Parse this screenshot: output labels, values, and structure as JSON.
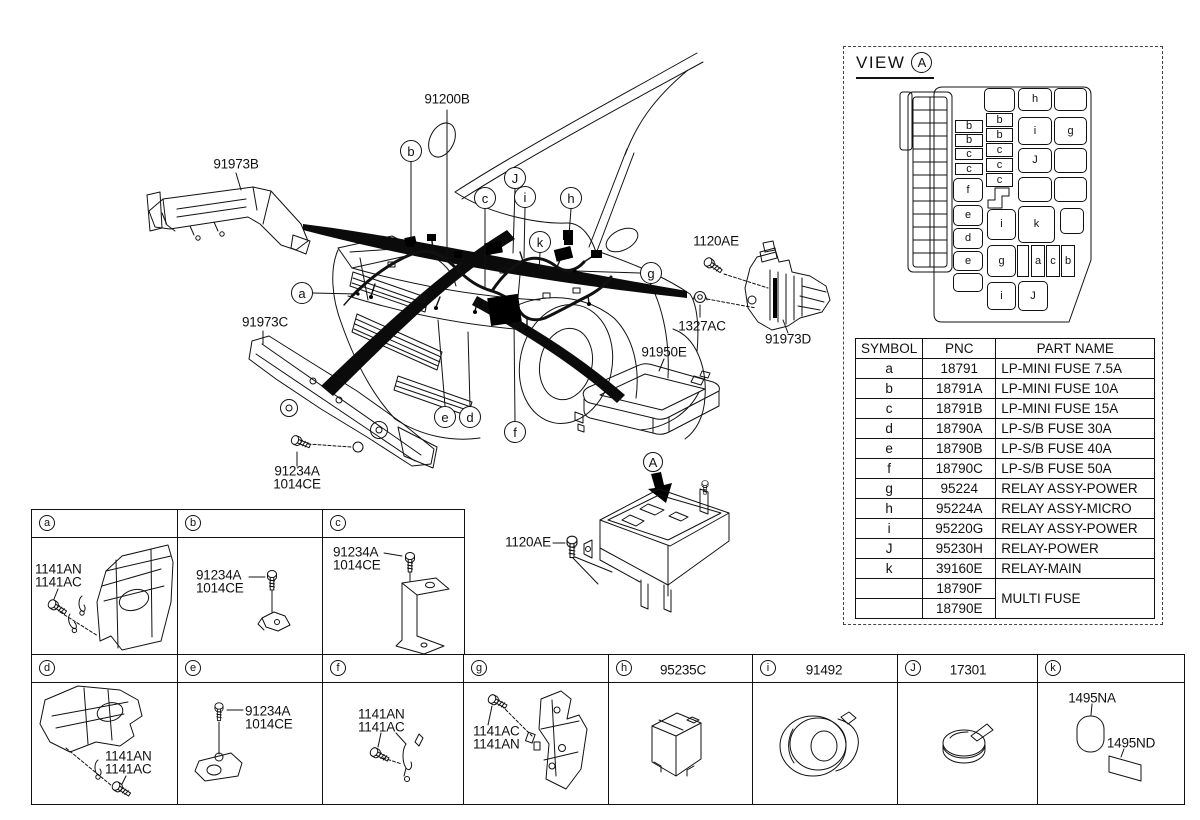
{
  "view_a": {
    "title": "VIEW",
    "balloon": "A",
    "table": {
      "headers": [
        "SYMBOL",
        "PNC",
        "PART NAME"
      ],
      "rows": [
        {
          "s": "a",
          "p": "18791",
          "n": "LP-MINI FUSE 7.5A"
        },
        {
          "s": "b",
          "p": "18791A",
          "n": "LP-MINI FUSE 10A"
        },
        {
          "s": "c",
          "p": "18791B",
          "n": "LP-MINI FUSE 15A"
        },
        {
          "s": "d",
          "p": "18790A",
          "n": "LP-S/B FUSE 30A"
        },
        {
          "s": "e",
          "p": "18790B",
          "n": "LP-S/B FUSE 40A"
        },
        {
          "s": "f",
          "p": "18790C",
          "n": "LP-S/B FUSE 50A"
        },
        {
          "s": "g",
          "p": "95224",
          "n": "RELAY ASSY-POWER"
        },
        {
          "s": "h",
          "p": "95224A",
          "n": "RELAY ASSY-MICRO"
        },
        {
          "s": "i",
          "p": "95220G",
          "n": "RELAY ASSY-POWER"
        },
        {
          "s": "J",
          "p": "95230H",
          "n": "RELAY-POWER"
        },
        {
          "s": "k",
          "p": "39160E",
          "n": "RELAY-MAIN"
        },
        {
          "s": "",
          "p": "18790F",
          "n": "MULTI FUSE",
          "span": 2
        },
        {
          "s": "",
          "p": "18790E",
          "n": null
        }
      ]
    },
    "fusebox_cells": [
      [
        "b",
        955,
        120,
        28,
        13,
        0
      ],
      [
        "b",
        955,
        134,
        28,
        13,
        0
      ],
      [
        "c",
        955,
        148,
        28,
        12,
        0
      ],
      [
        "c",
        955,
        163,
        28,
        12,
        0
      ],
      [
        "f",
        953,
        178,
        30,
        24,
        1
      ],
      [
        "e",
        953,
        205,
        30,
        21,
        1
      ],
      [
        "d",
        953,
        228,
        30,
        21,
        1
      ],
      [
        "e",
        953,
        251,
        30,
        20,
        1
      ],
      [
        "",
        953,
        273,
        30,
        19,
        1
      ],
      [
        "",
        984,
        88,
        31,
        24,
        1
      ],
      [
        "b",
        986,
        113,
        27,
        14,
        0
      ],
      [
        "b",
        986,
        128,
        27,
        14,
        0
      ],
      [
        "c",
        986,
        143,
        27,
        14,
        0
      ],
      [
        "c",
        986,
        158,
        27,
        14,
        0
      ],
      [
        "c",
        986,
        173,
        27,
        14,
        0
      ],
      [
        "i",
        987,
        209,
        29,
        31,
        1
      ],
      [
        "g",
        987,
        245,
        29,
        32,
        1
      ],
      [
        "i",
        987,
        282,
        29,
        28,
        1
      ],
      [
        "h",
        1018,
        88,
        34,
        23,
        1
      ],
      [
        "",
        1054,
        88,
        33,
        23,
        1
      ],
      [
        "i",
        1018,
        117,
        34,
        28,
        1
      ],
      [
        "g",
        1054,
        117,
        33,
        28,
        1
      ],
      [
        "J",
        1018,
        148,
        34,
        25,
        1
      ],
      [
        "",
        1054,
        148,
        33,
        25,
        1
      ],
      [
        "",
        1018,
        177,
        34,
        25,
        1
      ],
      [
        "",
        1054,
        177,
        33,
        25,
        1
      ],
      [
        "k",
        1018,
        206,
        37,
        37,
        1
      ],
      [
        "",
        1060,
        208,
        24,
        26,
        1
      ],
      [
        "",
        1017,
        245,
        12,
        32,
        0
      ],
      [
        "a",
        1031,
        245,
        14,
        32,
        0
      ],
      [
        "c",
        1046,
        245,
        14,
        32,
        0
      ],
      [
        "b",
        1061,
        245,
        14,
        32,
        0
      ],
      [
        "J",
        1018,
        281,
        30,
        30,
        1
      ]
    ]
  },
  "diagram": {
    "part_labels": [
      {
        "t": "91200B",
        "x": 447,
        "y": 99,
        "a": "c"
      },
      {
        "t": "91973B",
        "x": 236,
        "y": 164,
        "a": "c"
      },
      {
        "t": "91973C",
        "x": 265,
        "y": 322,
        "a": "c"
      },
      {
        "t": "91234A",
        "x": 297,
        "y": 471,
        "a": "c"
      },
      {
        "t": "1014CE",
        "x": 297,
        "y": 484,
        "a": "c"
      },
      {
        "t": "1120AE",
        "x": 716,
        "y": 241,
        "a": "c"
      },
      {
        "t": "1327AC",
        "x": 702,
        "y": 326,
        "a": "c"
      },
      {
        "t": "91973D",
        "x": 788,
        "y": 339,
        "a": "c"
      },
      {
        "t": "91950E",
        "x": 664,
        "y": 352,
        "a": "c"
      },
      {
        "t": "1120AE",
        "x": 528,
        "y": 542,
        "a": "c"
      }
    ],
    "callouts": [
      {
        "t": "a",
        "x": 302,
        "y": 293
      },
      {
        "t": "b",
        "x": 411,
        "y": 151
      },
      {
        "t": "c",
        "x": 485,
        "y": 198
      },
      {
        "t": "J",
        "x": 515,
        "y": 178
      },
      {
        "t": "i",
        "x": 525,
        "y": 197
      },
      {
        "t": "k",
        "x": 540,
        "y": 242
      },
      {
        "t": "h",
        "x": 571,
        "y": 198
      },
      {
        "t": "g",
        "x": 651,
        "y": 273
      },
      {
        "t": "e",
        "x": 445,
        "y": 417
      },
      {
        "t": "d",
        "x": 470,
        "y": 417
      },
      {
        "t": "f",
        "x": 515,
        "y": 432
      },
      {
        "t": "A",
        "x": 653,
        "y": 462,
        "r": 10
      }
    ]
  },
  "parts_grid": {
    "row1": {
      "x": 31,
      "y": 509,
      "h": 146,
      "cols": [
        146,
        145,
        141
      ],
      "letters": [
        "a",
        "b",
        "c"
      ]
    },
    "row2": {
      "x": 31,
      "y": 654,
      "h": 151,
      "cols": [
        146,
        145,
        141,
        145,
        144,
        145,
        140,
        146
      ],
      "letters": [
        "d",
        "e",
        "f",
        "g",
        "h",
        "i",
        "J",
        "k"
      ]
    },
    "header_codes": [
      {
        "t": "95235C",
        "x": 683,
        "y": 670,
        "a": "c"
      },
      {
        "t": "91492",
        "x": 824,
        "y": 670,
        "a": "c"
      },
      {
        "t": "17301",
        "x": 968,
        "y": 670,
        "a": "c"
      }
    ],
    "part_labels": [
      {
        "t": "1141AN",
        "x": 35,
        "y": 569,
        "a": "l"
      },
      {
        "t": "1141AC",
        "x": 35,
        "y": 582,
        "a": "l"
      },
      {
        "t": "91234A",
        "x": 196,
        "y": 575,
        "a": "l"
      },
      {
        "t": "1014CE",
        "x": 196,
        "y": 588,
        "a": "l"
      },
      {
        "t": "91234A",
        "x": 333,
        "y": 552,
        "a": "l"
      },
      {
        "t": "1014CE",
        "x": 333,
        "y": 565,
        "a": "l"
      },
      {
        "t": "1141AN",
        "x": 105,
        "y": 756,
        "a": "l"
      },
      {
        "t": "1141AC",
        "x": 105,
        "y": 769,
        "a": "l"
      },
      {
        "t": "91234A",
        "x": 245,
        "y": 711,
        "a": "l"
      },
      {
        "t": "1014CE",
        "x": 245,
        "y": 724,
        "a": "l"
      },
      {
        "t": "1141AN",
        "x": 358,
        "y": 714,
        "a": "l"
      },
      {
        "t": "1141AC",
        "x": 358,
        "y": 727,
        "a": "l"
      },
      {
        "t": "1141AC",
        "x": 473,
        "y": 731,
        "a": "l"
      },
      {
        "t": "1141AN",
        "x": 473,
        "y": 744,
        "a": "l"
      },
      {
        "t": "1495NA",
        "x": 1092,
        "y": 698,
        "a": "c"
      },
      {
        "t": "1495ND",
        "x": 1131,
        "y": 743,
        "a": "c"
      }
    ]
  }
}
